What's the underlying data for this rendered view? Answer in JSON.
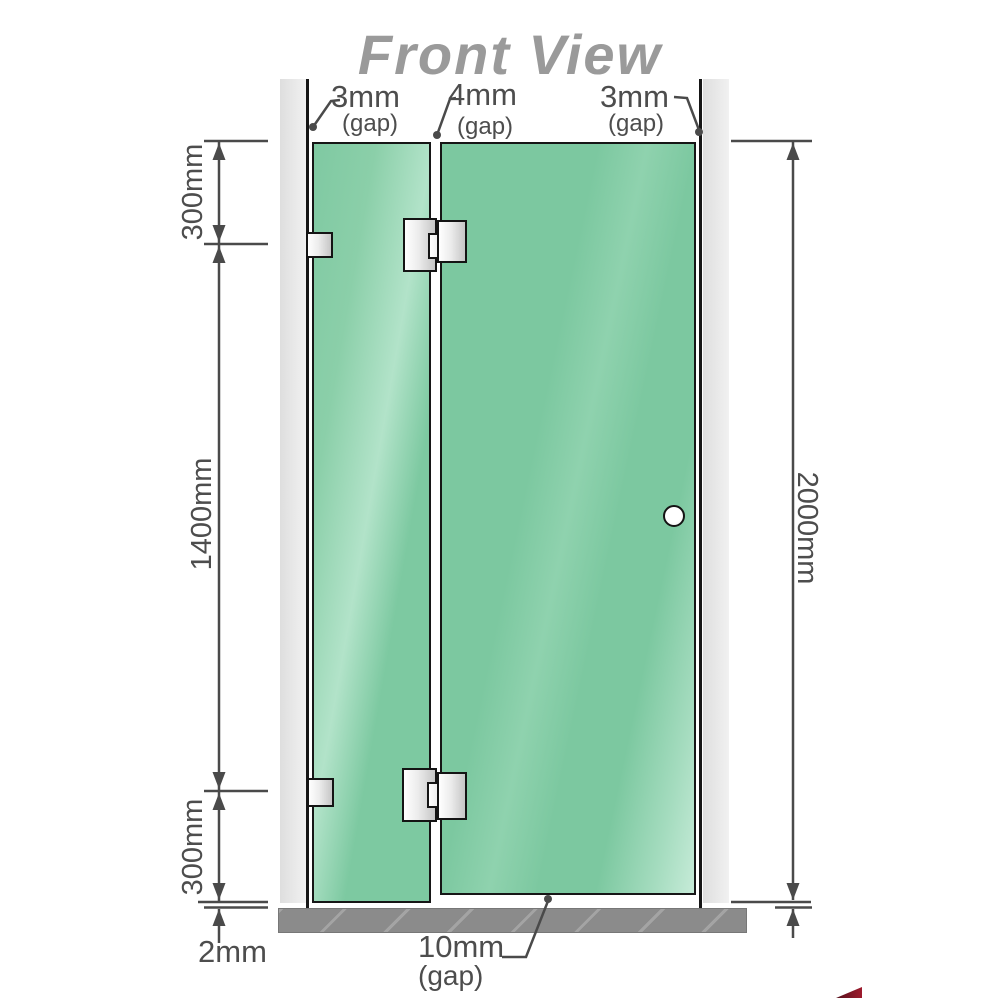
{
  "title": "Front View",
  "annotations": {
    "gap_top_left": {
      "value": "3mm",
      "sub": "(gap)"
    },
    "gap_top_middle": {
      "value": "4mm",
      "sub": "(gap)"
    },
    "gap_top_right": {
      "value": "3mm",
      "sub": "(gap)"
    },
    "segment_top": "300mm",
    "segment_middle": "1400mm",
    "segment_bottom": "300mm",
    "total_height": "2000mm",
    "floor_gap": "2mm",
    "door_bottom_gap": {
      "value": "10mm",
      "sub": "(gap)"
    }
  },
  "colors": {
    "glass": "#7dc9a1",
    "glass_highlight": "#b2e3c9",
    "glass_border": "#161616",
    "wall_channel": "#e7e7e7",
    "floor": "#8b8b8b",
    "hardware_light": "#ffffff",
    "hardware_dark": "#c6c6c6",
    "dimension": "#4a4a4a",
    "title": "#9a9a9a",
    "logo_accent": "#9e1b2d"
  }
}
